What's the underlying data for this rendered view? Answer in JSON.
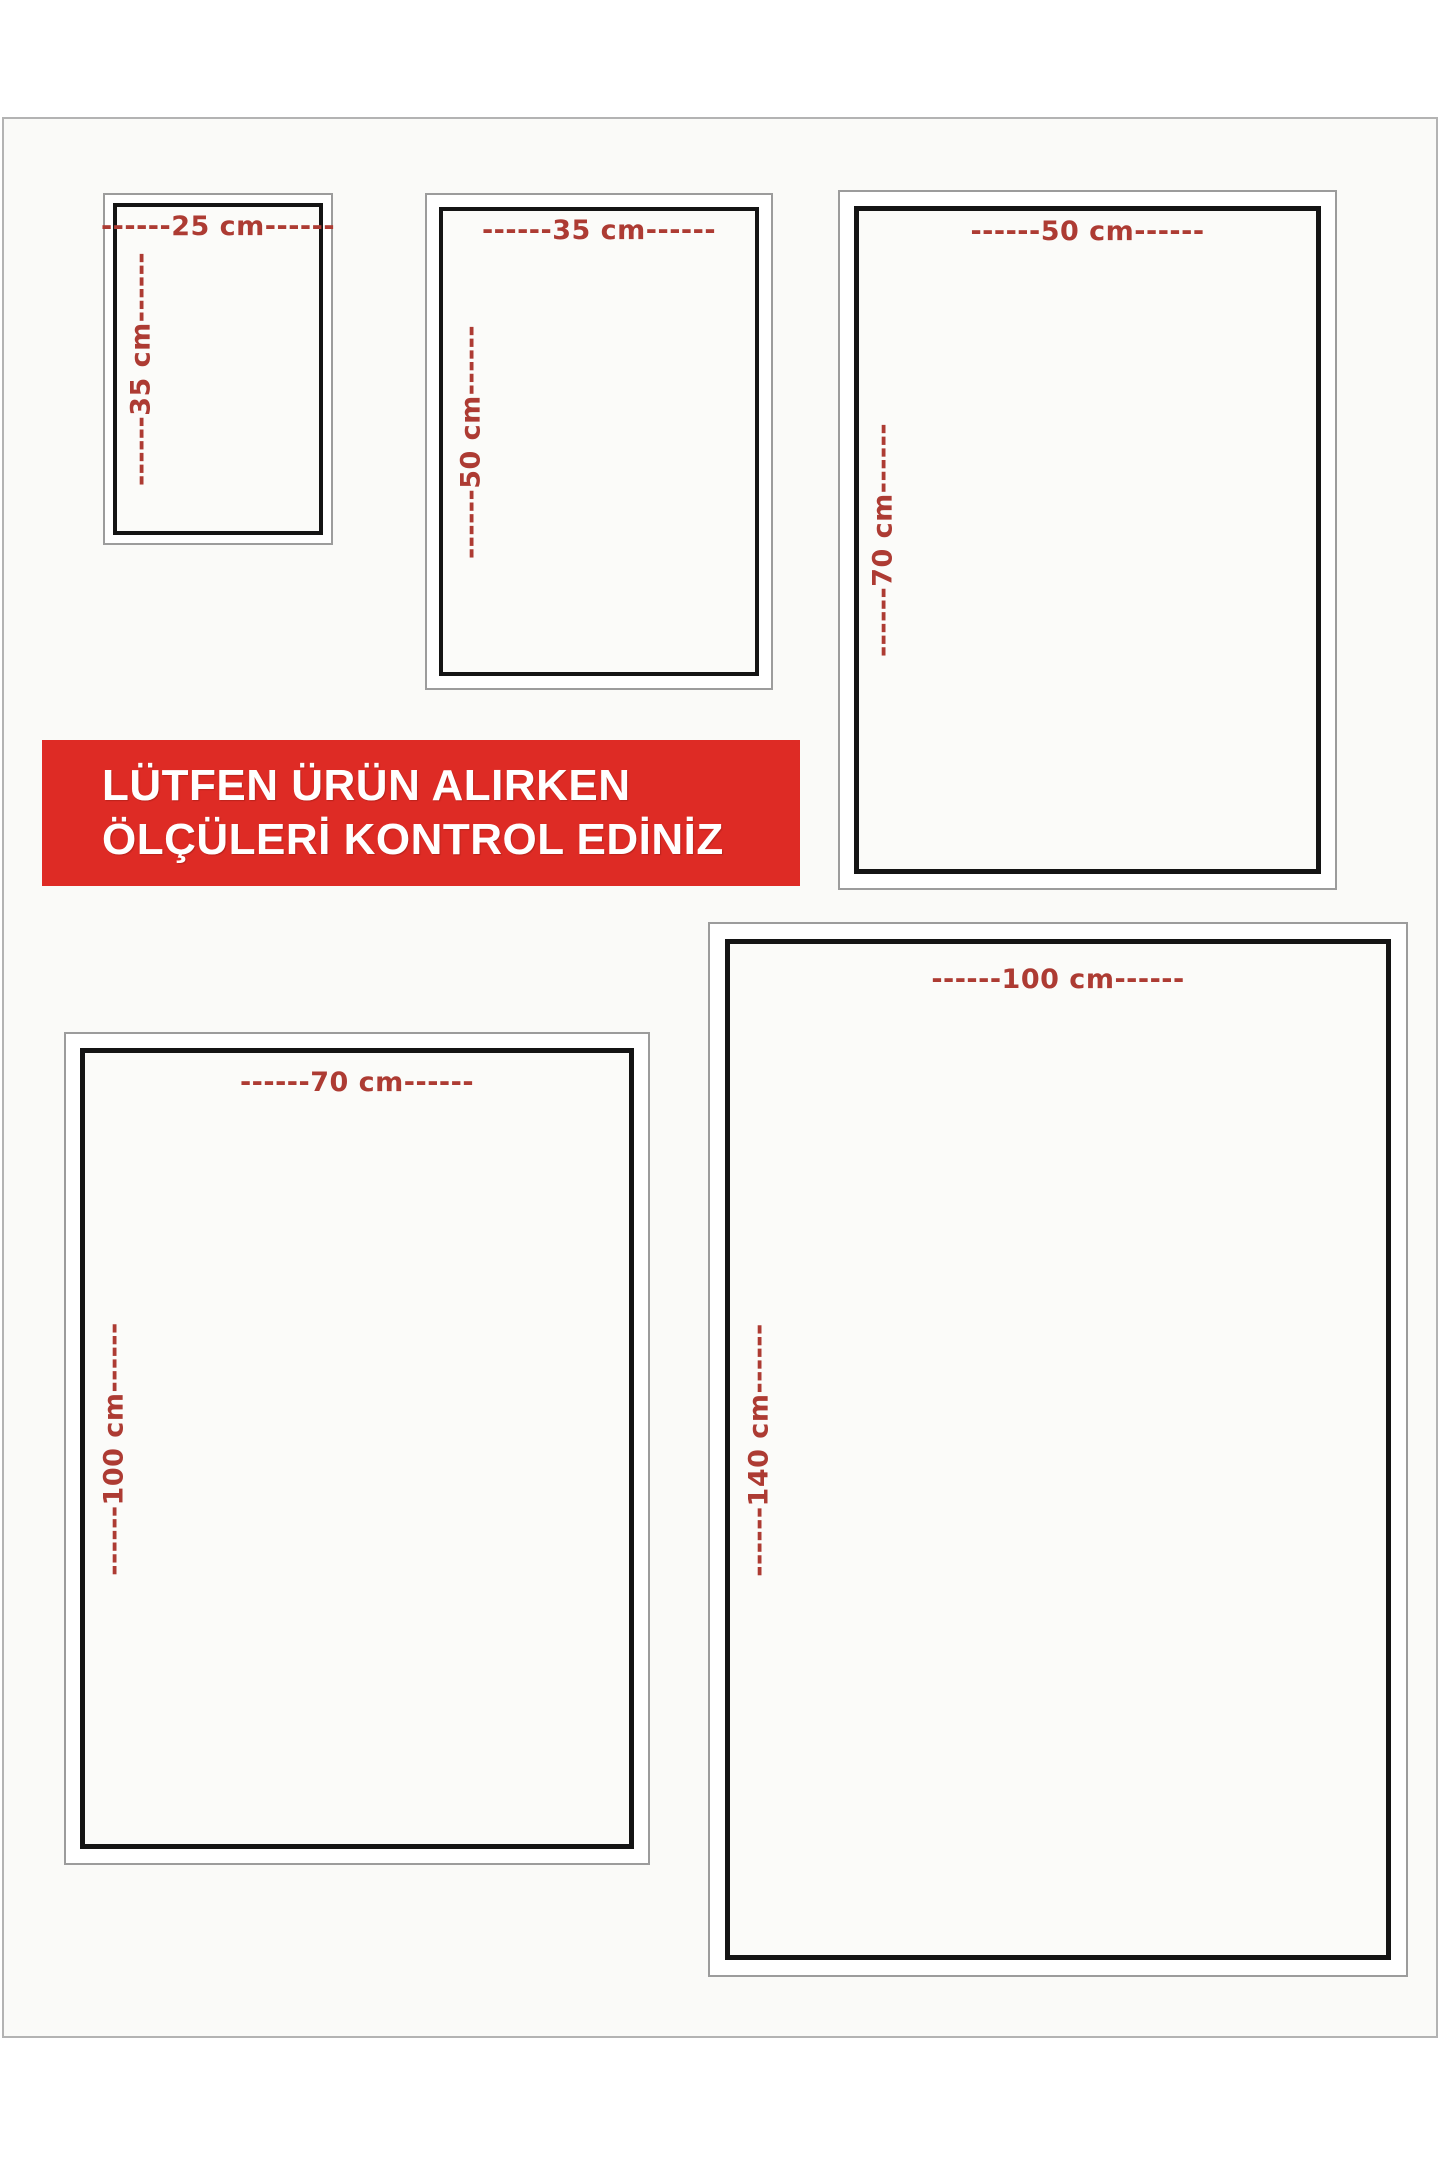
{
  "banner": {
    "line1": "LÜTFEN ÜRÜN ALIRKEN",
    "line2": "ÖLÇÜLERİ KONTROL EDİNİZ"
  },
  "sizes": [
    {
      "name": "25x35",
      "width_cm": 25,
      "height_cm": 35,
      "width_label": "------25 cm------",
      "height_label": "------35 cm------"
    },
    {
      "name": "35x50",
      "width_cm": 35,
      "height_cm": 50,
      "width_label": "------35 cm------",
      "height_label": "------50 cm------"
    },
    {
      "name": "50x70",
      "width_cm": 50,
      "height_cm": 70,
      "width_label": "------50 cm------",
      "height_label": "------70 cm------"
    },
    {
      "name": "70x100",
      "width_cm": 70,
      "height_cm": 100,
      "width_label": "------70 cm------",
      "height_label": "------100 cm------"
    },
    {
      "name": "100x140",
      "width_cm": 100,
      "height_cm": 140,
      "width_label": "------100 cm------",
      "height_label": "------140 cm------"
    }
  ],
  "colors": {
    "banner-bg": "#de2b25",
    "banner-text": "#ffffff",
    "dimension-text": "#ad3b33",
    "box-border": "#141414",
    "outer-border": "#9c9c9c",
    "page-bg": "#fafaf8",
    "page-border": "#b3b3b3",
    "canvas-bg": "#ffffff"
  }
}
